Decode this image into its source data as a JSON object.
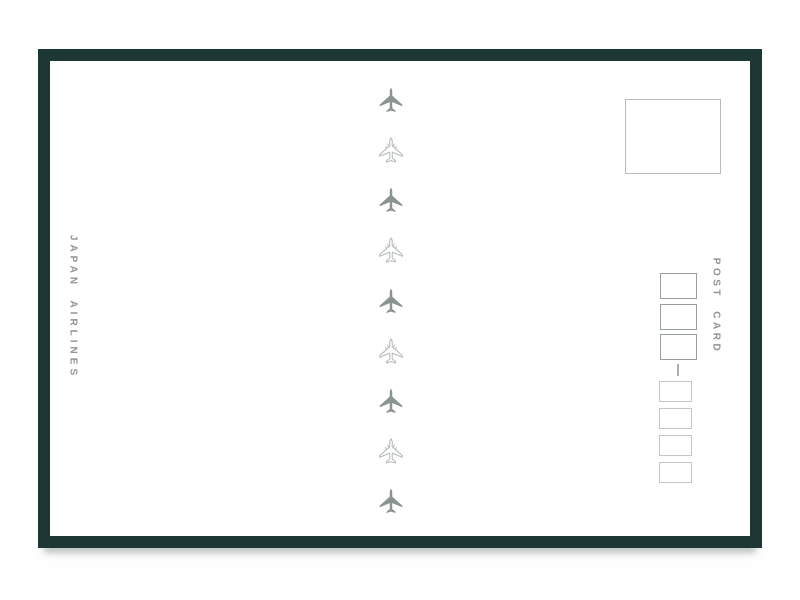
{
  "page": {
    "background": "#ffffff",
    "description": "Back side of a Japan Airlines postcard, scanned on white"
  },
  "postcard": {
    "left_edge_text": "JAPAN AIRLINES",
    "right_edge_text": "POST CARD",
    "center_planes": [
      "solid",
      "outline",
      "solid",
      "outline",
      "solid",
      "outline",
      "solid",
      "outline",
      "solid"
    ],
    "postal_code_boxes": {
      "upper_count": 3,
      "lower_count": 4,
      "separator": "vertical-dash"
    },
    "stamp_box_present": true,
    "colors": {
      "frame": "#1d3734",
      "plane_solid": "#8b9492",
      "plane_outline": "#b6bcba",
      "side_text": "#8e9594",
      "stamp_border": "#b7bdbc",
      "upper_box_border": "#98a09e",
      "lower_box_border": "#c3c8c6",
      "dash": "#a9b0ae"
    }
  }
}
